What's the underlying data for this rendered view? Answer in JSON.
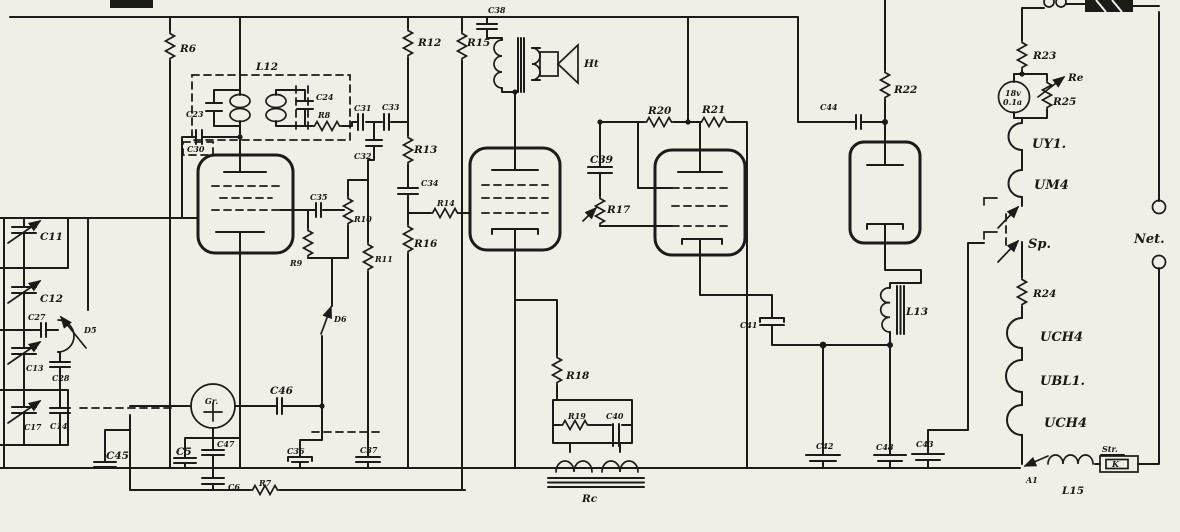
{
  "diagram": {
    "title": "vintage-tube-radio-schematic",
    "ink_color": "#1c1b18",
    "paper_color": "#f1eee7",
    "labels": {
      "r6": "R6",
      "l12": "L12",
      "c23": "C23",
      "c24": "C24",
      "r8": "R8",
      "c30": "C30",
      "c31": "C31",
      "c33": "C33",
      "c32": "C32",
      "r12": "R12",
      "r13": "R13",
      "r15": "R15",
      "c38": "C38",
      "ht": "Ht",
      "c34": "C34",
      "r14": "R14",
      "r16": "R16",
      "c35": "C35",
      "r10": "R10",
      "r9": "R9",
      "r11": "R11",
      "d6": "D6",
      "c39": "C39",
      "r17": "R17",
      "r20": "R20",
      "r21": "R21",
      "r18": "R18",
      "r19": "R19",
      "c40": "C40",
      "rc": "Rc",
      "gr": "Gr.",
      "c46": "C46",
      "c45": "C45",
      "c5": "C5",
      "c47": "C47",
      "c36": "C36",
      "c37": "C37",
      "c6": "C6",
      "r7": "R7",
      "c11": "C11",
      "c12": "C12",
      "c27": "C27",
      "d5": "D5",
      "c13": "C13",
      "c28": "C28",
      "c17": "C17",
      "c14": "C14",
      "c44": "C44",
      "r22": "R22",
      "c41": "C41",
      "l13": "L13",
      "c42": "C42",
      "c48": "C48",
      "c43": "C43",
      "r23": "R23",
      "re": "Re",
      "lamp1": "18v",
      "lamp2": "0.1a",
      "r25": "R25",
      "uy1": "UY1.",
      "um4": "UM4",
      "sp": "Sp.",
      "r24": "R24",
      "uch4a": "UCH4",
      "ubl1": "UBL1.",
      "uch4b": "UCH4",
      "net": "Net.",
      "a1": "A1",
      "l15": "L15",
      "str": "Str.",
      "k": "K"
    }
  }
}
